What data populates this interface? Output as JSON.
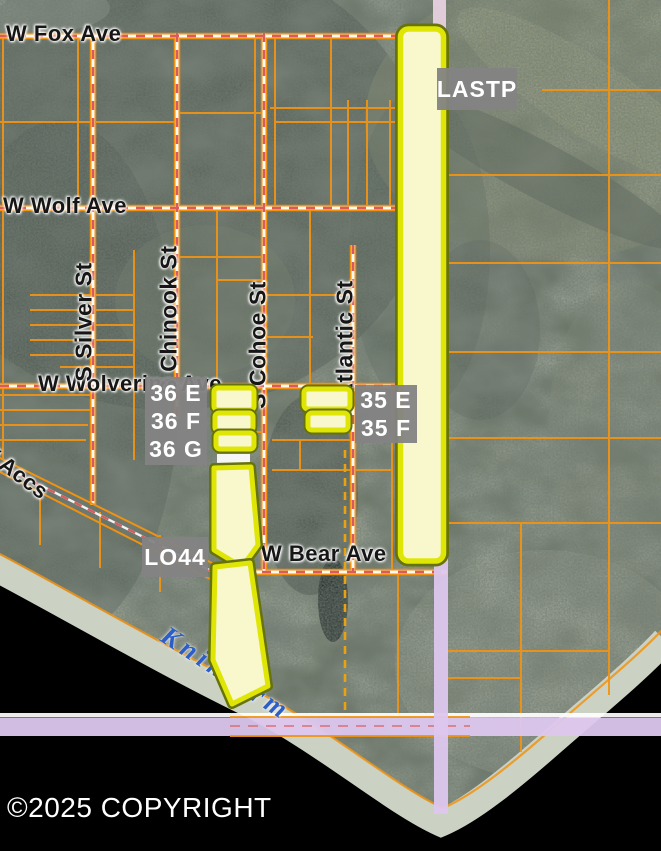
{
  "map": {
    "streets": {
      "fox": "W Fox Ave",
      "wolf": "W Wolf Ave",
      "wolverine": "W Wolverine Ave",
      "bear": "W Bear Ave",
      "accs": "W Accs",
      "silver": "S Silver St",
      "chinook": "S Chinook St",
      "cohoe": "S Cohoe St",
      "atlantic": "Atlantic St"
    },
    "parcel_labels": {
      "lastp": "LASTP",
      "p36e": "36 E",
      "p36f": "36 F",
      "p36g": "36 G",
      "p35e": "35 E",
      "p35f": "35 F",
      "lo44": "LO44"
    },
    "water_label": "Knik Arm",
    "copyright": "©2025 COPYRIGHT",
    "colors": {
      "parcel_line": "#f09414",
      "highlight_fill": "#f8f8cc",
      "highlight_stroke": "#dfe606",
      "highlight_stroke_dark": "#67730a",
      "label_box_bg": "#838383",
      "label_box_text": "#ffffff",
      "road_band_lavender": "#ddc7ee",
      "road_dash_red": "#d95b5b",
      "water_label_blue": "#2b5fc7",
      "beach": "#cbd2c3",
      "water": "#000000"
    }
  }
}
